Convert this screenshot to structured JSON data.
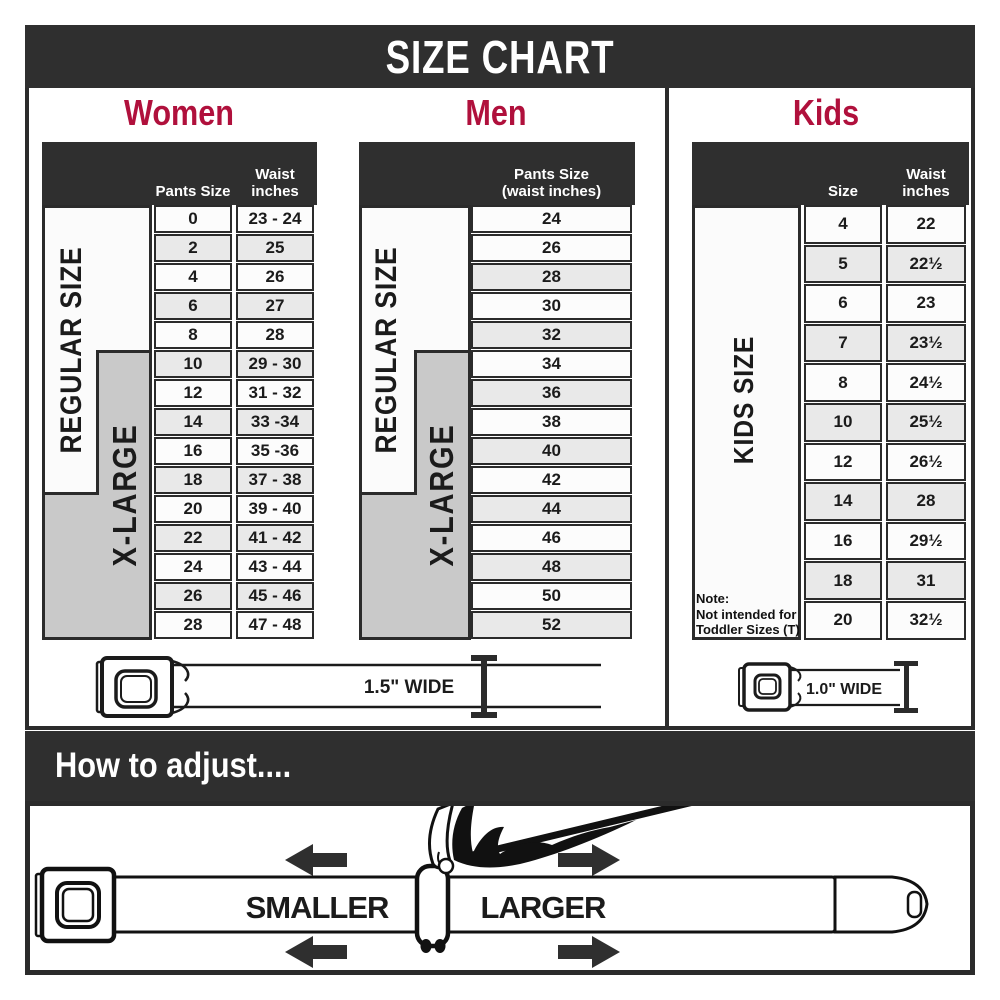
{
  "header": {
    "title": "SIZE CHART"
  },
  "colors": {
    "accent": "#b0103c",
    "dark": "#2f2f2f",
    "gray_box": "#c9c9c9",
    "row_shaded": "#e9e9e9"
  },
  "sections": {
    "women": {
      "title": "Women",
      "columns": {
        "col1": "Pants Size",
        "col2": "Waist inches"
      },
      "side_labels": {
        "regular": "REGULAR SIZE",
        "xlarge": "X-LARGE"
      },
      "rows": [
        {
          "size": "0",
          "waist": "23 - 24"
        },
        {
          "size": "2",
          "waist": "25"
        },
        {
          "size": "4",
          "waist": "26"
        },
        {
          "size": "6",
          "waist": "27"
        },
        {
          "size": "8",
          "waist": "28"
        },
        {
          "size": "10",
          "waist": "29 - 30"
        },
        {
          "size": "12",
          "waist": "31 - 32"
        },
        {
          "size": "14",
          "waist": "33 -34"
        },
        {
          "size": "16",
          "waist": "35 -36"
        },
        {
          "size": "18",
          "waist": "37 - 38"
        },
        {
          "size": "20",
          "waist": "39 - 40"
        },
        {
          "size": "22",
          "waist": "41 - 42"
        },
        {
          "size": "24",
          "waist": "43 - 44"
        },
        {
          "size": "26",
          "waist": "45 - 46"
        },
        {
          "size": "28",
          "waist": "47 - 48"
        }
      ]
    },
    "men": {
      "title": "Men",
      "columns": {
        "col1": "Pants Size\n(waist inches)"
      },
      "side_labels": {
        "regular": "REGULAR SIZE",
        "xlarge": "X-LARGE"
      },
      "rows": [
        "24",
        "26",
        "28",
        "30",
        "32",
        "34",
        "36",
        "38",
        "40",
        "42",
        "44",
        "46",
        "48",
        "50",
        "52"
      ]
    },
    "kids": {
      "title": "Kids",
      "columns": {
        "col1": "Size",
        "col2": "Waist inches"
      },
      "side_label": "KIDS SIZE",
      "note": "Note:\nNot intended for\nToddler Sizes (T)",
      "rows": [
        {
          "size": "4",
          "waist": "22"
        },
        {
          "size": "5",
          "waist": "22½"
        },
        {
          "size": "6",
          "waist": "23"
        },
        {
          "size": "7",
          "waist": "23½"
        },
        {
          "size": "8",
          "waist": "24½"
        },
        {
          "size": "10",
          "waist": "25½"
        },
        {
          "size": "12",
          "waist": "26½"
        },
        {
          "size": "14",
          "waist": "28"
        },
        {
          "size": "16",
          "waist": "29½"
        },
        {
          "size": "18",
          "waist": "31"
        },
        {
          "size": "20",
          "waist": "32½"
        }
      ]
    }
  },
  "belts": {
    "adult_width_label": "1.5\" WIDE",
    "kids_width_label": "1.0\" WIDE"
  },
  "adjust": {
    "heading": "How to adjust....",
    "smaller": "SMALLER",
    "larger": "LARGER"
  }
}
